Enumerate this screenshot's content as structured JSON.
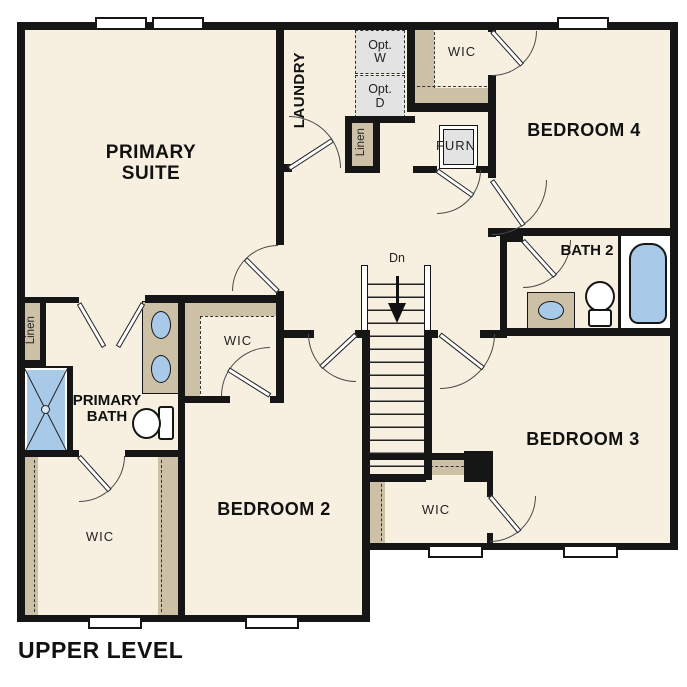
{
  "title": "UPPER LEVEL",
  "colors": {
    "floor_cream": "#f7f0e1",
    "closet_tan": "#ccc0a6",
    "fixture_blue": "#a9c9e9",
    "wall_black": "#161616",
    "optional_gray": "#e3e3e3"
  },
  "rooms": {
    "primary_suite": "PRIMARY SUITE",
    "laundry": "LAUNDRY",
    "bedroom4": "BEDROOM 4",
    "bedroom3": "BEDROOM 3",
    "bedroom2": "BEDROOM 2",
    "bath2": "BATH 2",
    "primary_bath": "PRIMARY BATH",
    "wic_top": "WIC",
    "wic_bedroom2": "WIC",
    "wic_primary": "WIC",
    "wic_bedroom3": "WIC",
    "linen_left": "Linen",
    "linen_top": "Linen",
    "furnace": "FURN",
    "opt_washer": "Opt. W",
    "opt_dryer": "Opt. D",
    "stairs_down": "Dn"
  }
}
